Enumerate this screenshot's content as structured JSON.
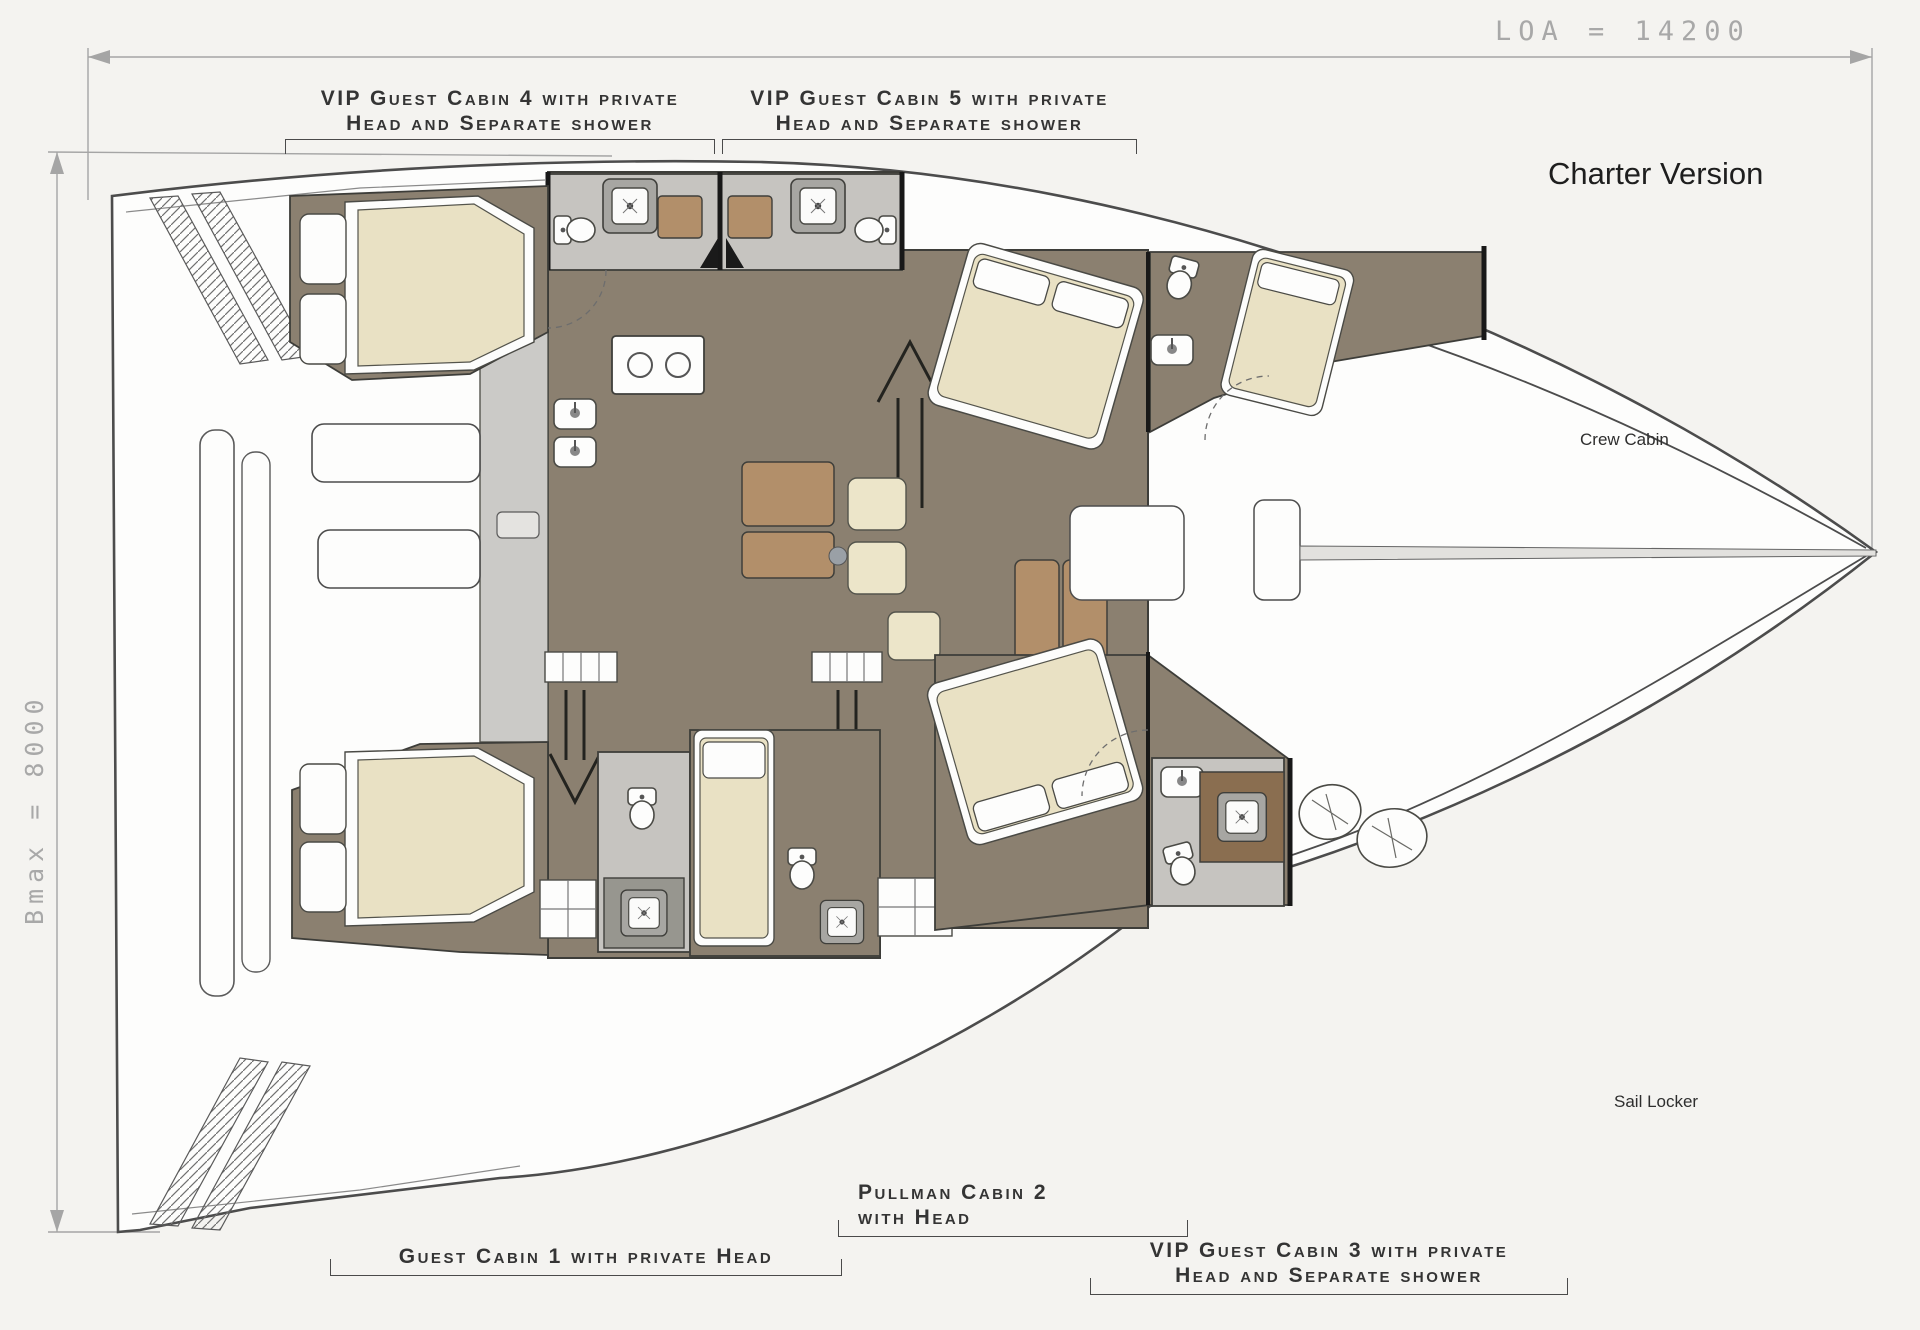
{
  "header": {
    "title": "Charter Version"
  },
  "dimensions": {
    "loa": "LOA = 14200",
    "bmax": "Bmax = 8000"
  },
  "cabin_labels": {
    "cabin4_line1": "VIP Guest Cabin 4 with private",
    "cabin4_line2": "Head and Separate shower",
    "cabin5_line1": "VIP Guest Cabin 5 with private",
    "cabin5_line2": "Head and Separate shower",
    "cabin1_line1": "Guest Cabin 1 with private Head",
    "cabin2_line1": "Pullman Cabin 2",
    "cabin2_line2": "with Head",
    "cabin3_line1": "VIP Guest Cabin 3 with private",
    "cabin3_line2": "Head and Separate shower"
  },
  "area_labels": {
    "crew_cabin": "Crew Cabin",
    "sail_locker": "Sail Locker"
  },
  "colors": {
    "floor_olive": "#8b8070",
    "cushion_cream": "#e9e1c4",
    "wood_tan": "#b28f6a",
    "tile_gray": "#c6c4c0",
    "deck_gray": "#cbcac7",
    "outline": "#4c4c4c",
    "dimension_gray": "#a8a8a8"
  }
}
